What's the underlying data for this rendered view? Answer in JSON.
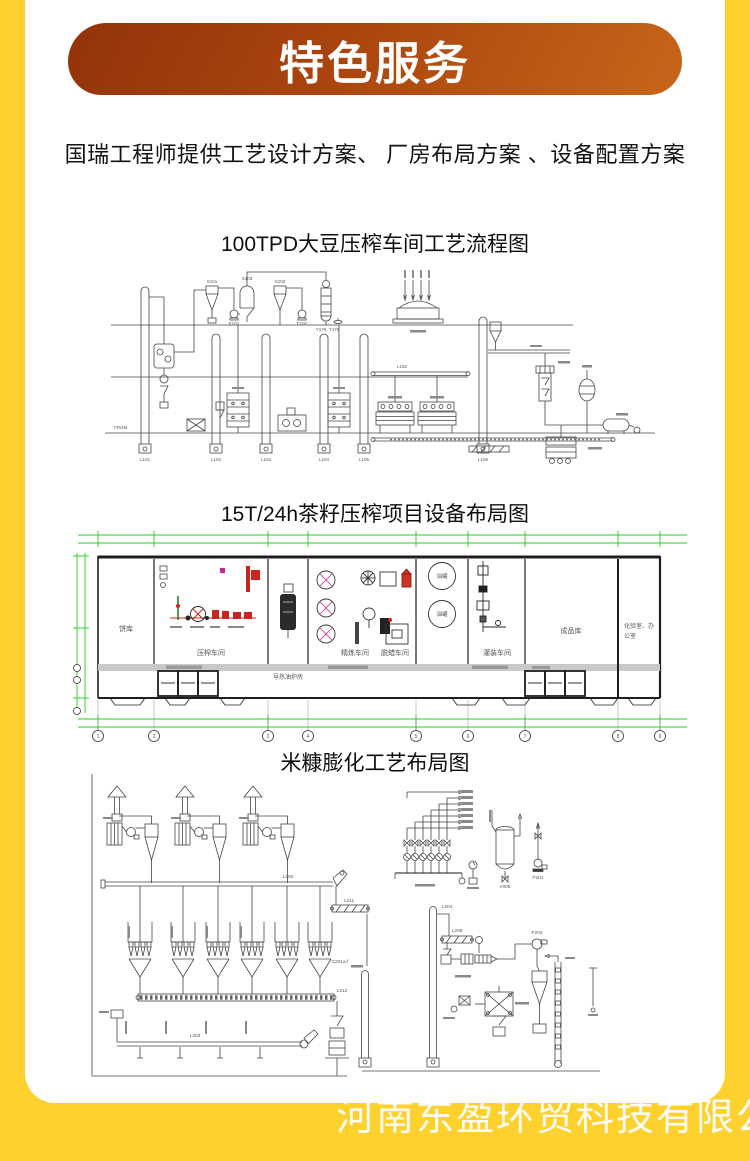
{
  "page": {
    "background_color": "#FFD12E",
    "card_color": "#FFFFFF",
    "banner_gradient_from": "#93330A",
    "banner_gradient_to": "#C7661A",
    "dimension_line_color": "#21D121",
    "equipment_highlight_color": "#CC2222"
  },
  "banner": {
    "title": "特色服务"
  },
  "intro": {
    "text": "国瑞工程师提供工艺设计方案、 厂房布局方案 、设备配置方案"
  },
  "diagrams": [
    {
      "title": "100TPD大豆压榨车间工艺流程图"
    },
    {
      "title": "15T/24h茶籽压榨项目设备布局图"
    },
    {
      "title": "米糠膨化工艺布局图"
    }
  ],
  "flow_diagram": {
    "equipment_labels": {
      "s101": "S101",
      "s103": "S103",
      "s102": "S102",
      "f101": "F101",
      "f102": "F102",
      "y176": "Y176",
      "y175": "Y175",
      "l152": "L152",
      "from": "FROM"
    },
    "elevator_labels": [
      "L101",
      "L102",
      "L103",
      "L104",
      "L105",
      "L106"
    ]
  },
  "floor_plan": {
    "rooms": [
      {
        "label": "饼库"
      },
      {
        "label": "压榨车间"
      },
      {
        "label": "导热油炉房"
      },
      {
        "label": "精炼车间"
      },
      {
        "label": "脱蜡车间"
      },
      {
        "label": "灌装车间"
      },
      {
        "label": "成品库"
      },
      {
        "label": "化验室、办",
        "label2": "公室"
      }
    ],
    "tank_label": "油罐",
    "axis_numbers": [
      "1",
      "2",
      "3",
      "4",
      "5",
      "6",
      "7",
      "8",
      "9"
    ]
  },
  "layout_diagram": {
    "labels": {
      "l202": "L202",
      "l211": "L211",
      "l212": "L212",
      "c201": "C201a-f",
      "l206": "L206",
      "l204": "L204",
      "l203": "L203",
      "f202": "F202",
      "v005": "V005",
      "p201": "P201"
    }
  },
  "watermark": {
    "text": "河南东盈环贸科技有限公司"
  }
}
